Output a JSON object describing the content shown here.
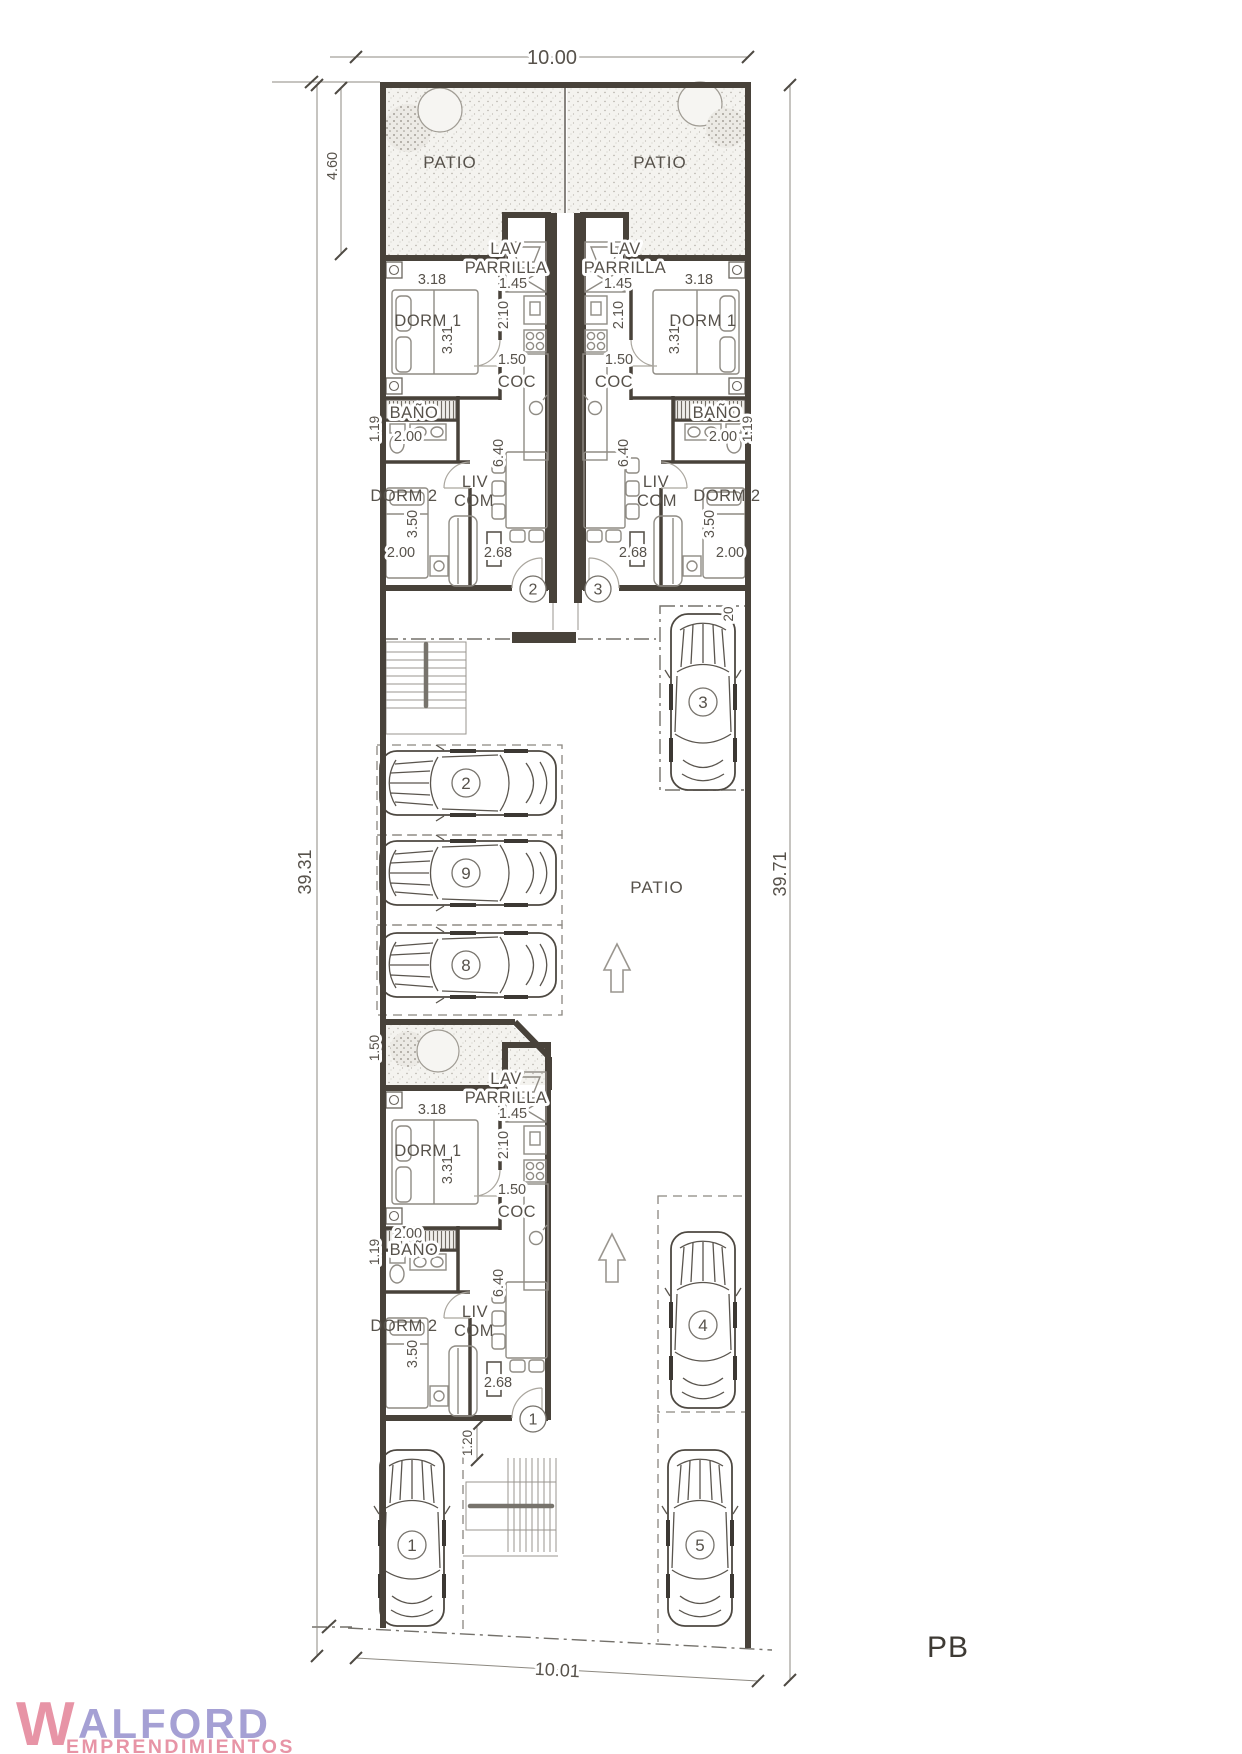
{
  "plan": {
    "label": "PB"
  },
  "dims": {
    "width_top": "10.00",
    "width_bottom": "10.01",
    "depth_left": "39.31",
    "depth_right": "39.71",
    "front_patio": "4.60",
    "rear_patio": "1.50",
    "entry_path": "1.20",
    "car3_len": "20",
    "dorm1_w": "3.18",
    "dorm1_d": "3.31",
    "lav_w": "1.45",
    "lav_d": "2.10",
    "coc_w": "1.50",
    "livcom_d": "6.40",
    "livcom_w": "2.68",
    "bano_w": "2.00",
    "bano_d": "1.19",
    "dorm2_w": "2.00",
    "dorm2_d": "3.50"
  },
  "rooms": {
    "dorm1": "DORM 1",
    "dorm2": "DORM 2",
    "bano": "BAÑO",
    "lav": "LAV",
    "parrilla": "PARRILLA",
    "coc": "COC",
    "liv": "LIV",
    "com": "COM",
    "patio": "PATIO"
  },
  "entries": {
    "e1": "1",
    "e2": "2",
    "e3": "3"
  },
  "parking": {
    "p1": "1",
    "p2": "2",
    "p3": "3",
    "p4": "4",
    "p5": "5",
    "p8": "8",
    "p9": "9"
  },
  "logo": {
    "initial": "W",
    "name_rest": "ALFORD",
    "tagline": "EMPRENDIMIENTOS"
  },
  "colors": {
    "wall": "#48423a",
    "line": "#8f8b84",
    "text": "#57524b",
    "dash": "#8a867f",
    "logo_pink": "#e794a6",
    "logo_purple": "#a5a0d4",
    "plan_label": "#3e3a34"
  }
}
